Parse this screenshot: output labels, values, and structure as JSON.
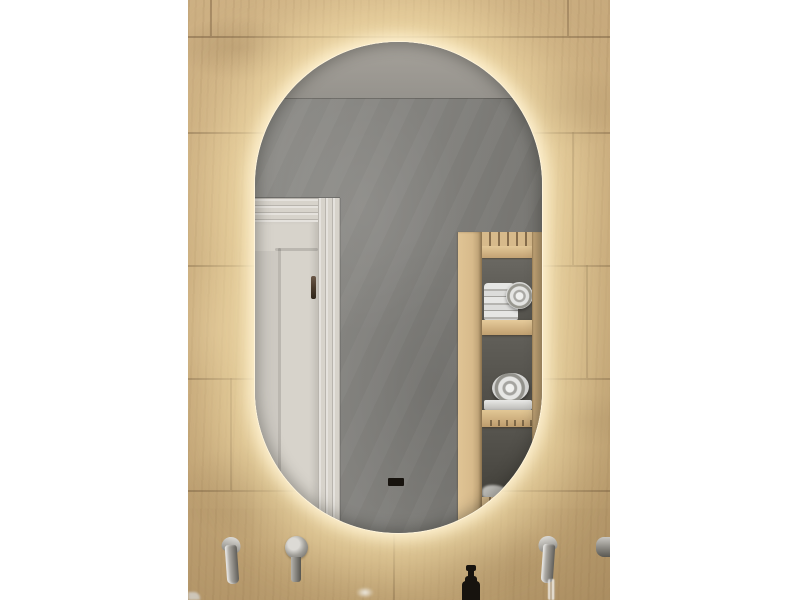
{
  "scene": {
    "type": "product-photo",
    "description": "Capsule-shaped LED backlit bathroom mirror mounted on a light oak plank-tiled wall. The mirror reflects a grey plastered wall, a white panelled door with a bronze handle on the left, and a pine open shelf unit holding rolled and folded white towels on the right. Below the mirror are wall-mounted chrome taps, a round chrome mixer handle, a running water stream, and a black soap dispenser pump bottle. White page margins frame the photo on left and right.",
    "objects": {
      "mirror": "oval LED backlit mirror with warm glow",
      "wall": "light oak wood plank tiled wall",
      "reflection_wall": "grey concrete plaster wall and ceiling",
      "reflection_door": "white panelled door with dark bronze handle",
      "reflection_shelf": "pine slatted towel shelf with folded and rolled towels",
      "fixtures": [
        "left wall-mounted chrome spout",
        "left round chrome mixer handle",
        "right chrome spout with running water",
        "far-right partial chrome fixture",
        "black soap dispenser pump bottle"
      ]
    },
    "colors": {
      "page_background": "#ffffff",
      "wood_base": "#bd9f72",
      "glow_core": "#fff3d4",
      "mirror_wall_light": "#8f8e8a",
      "mirror_wall_dark": "#6e6d69",
      "door": "#d7d3cb",
      "handle": "#4a3b2c",
      "shelf_wood": "#d7ba8b",
      "towel": "#e6e6e4",
      "chrome_light": "#dcdad5",
      "chrome_dark": "#5f5d58",
      "dispenser": "#17130e"
    }
  }
}
